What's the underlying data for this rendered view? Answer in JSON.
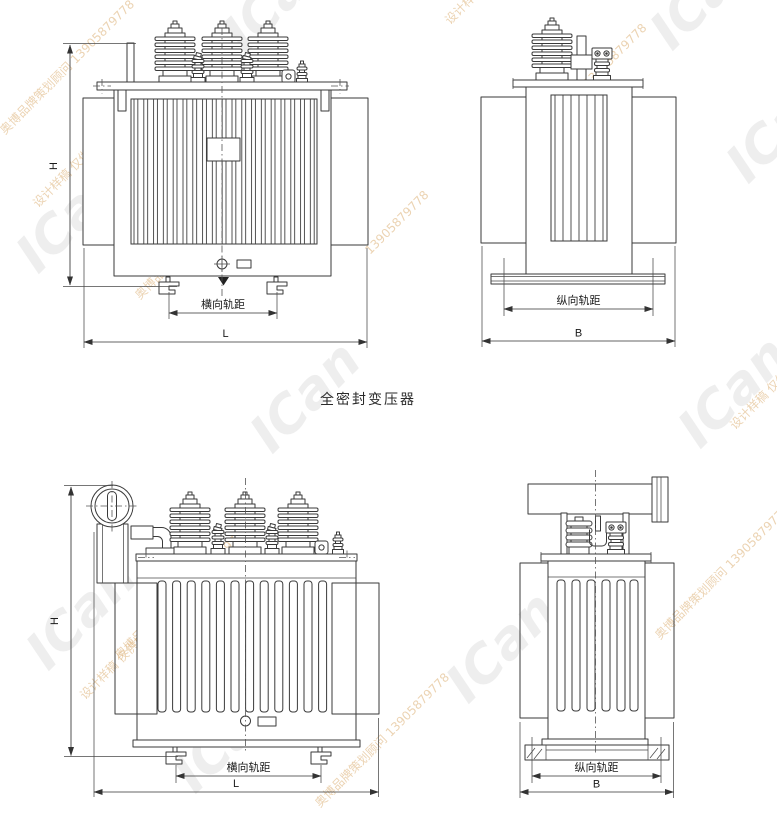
{
  "title": "全密封变压器",
  "drawing": {
    "top_front": {
      "h_label": "H",
      "l_label": "L",
      "track_label": "横向轨距"
    },
    "top_side": {
      "b_label": "B",
      "track_label": "纵向轨距"
    },
    "bottom_front": {
      "h_label": "H",
      "l_label": "L",
      "track_label": "横向轨距"
    },
    "bottom_side": {
      "b_label": "B",
      "track_label": "纵向轨距"
    }
  },
  "watermark": {
    "logo": "ICan",
    "agency_line": "奥博品牌策划顾问 13905879778",
    "proof_line": "设计样稿 仅供校对 请勿外发",
    "phone": "13905879778"
  },
  "colors": {
    "line": "#3a3a3a",
    "dimension": "#333333",
    "watermark_gray": "#cccccc",
    "watermark_tan": "#d9a868",
    "background": "#ffffff"
  }
}
